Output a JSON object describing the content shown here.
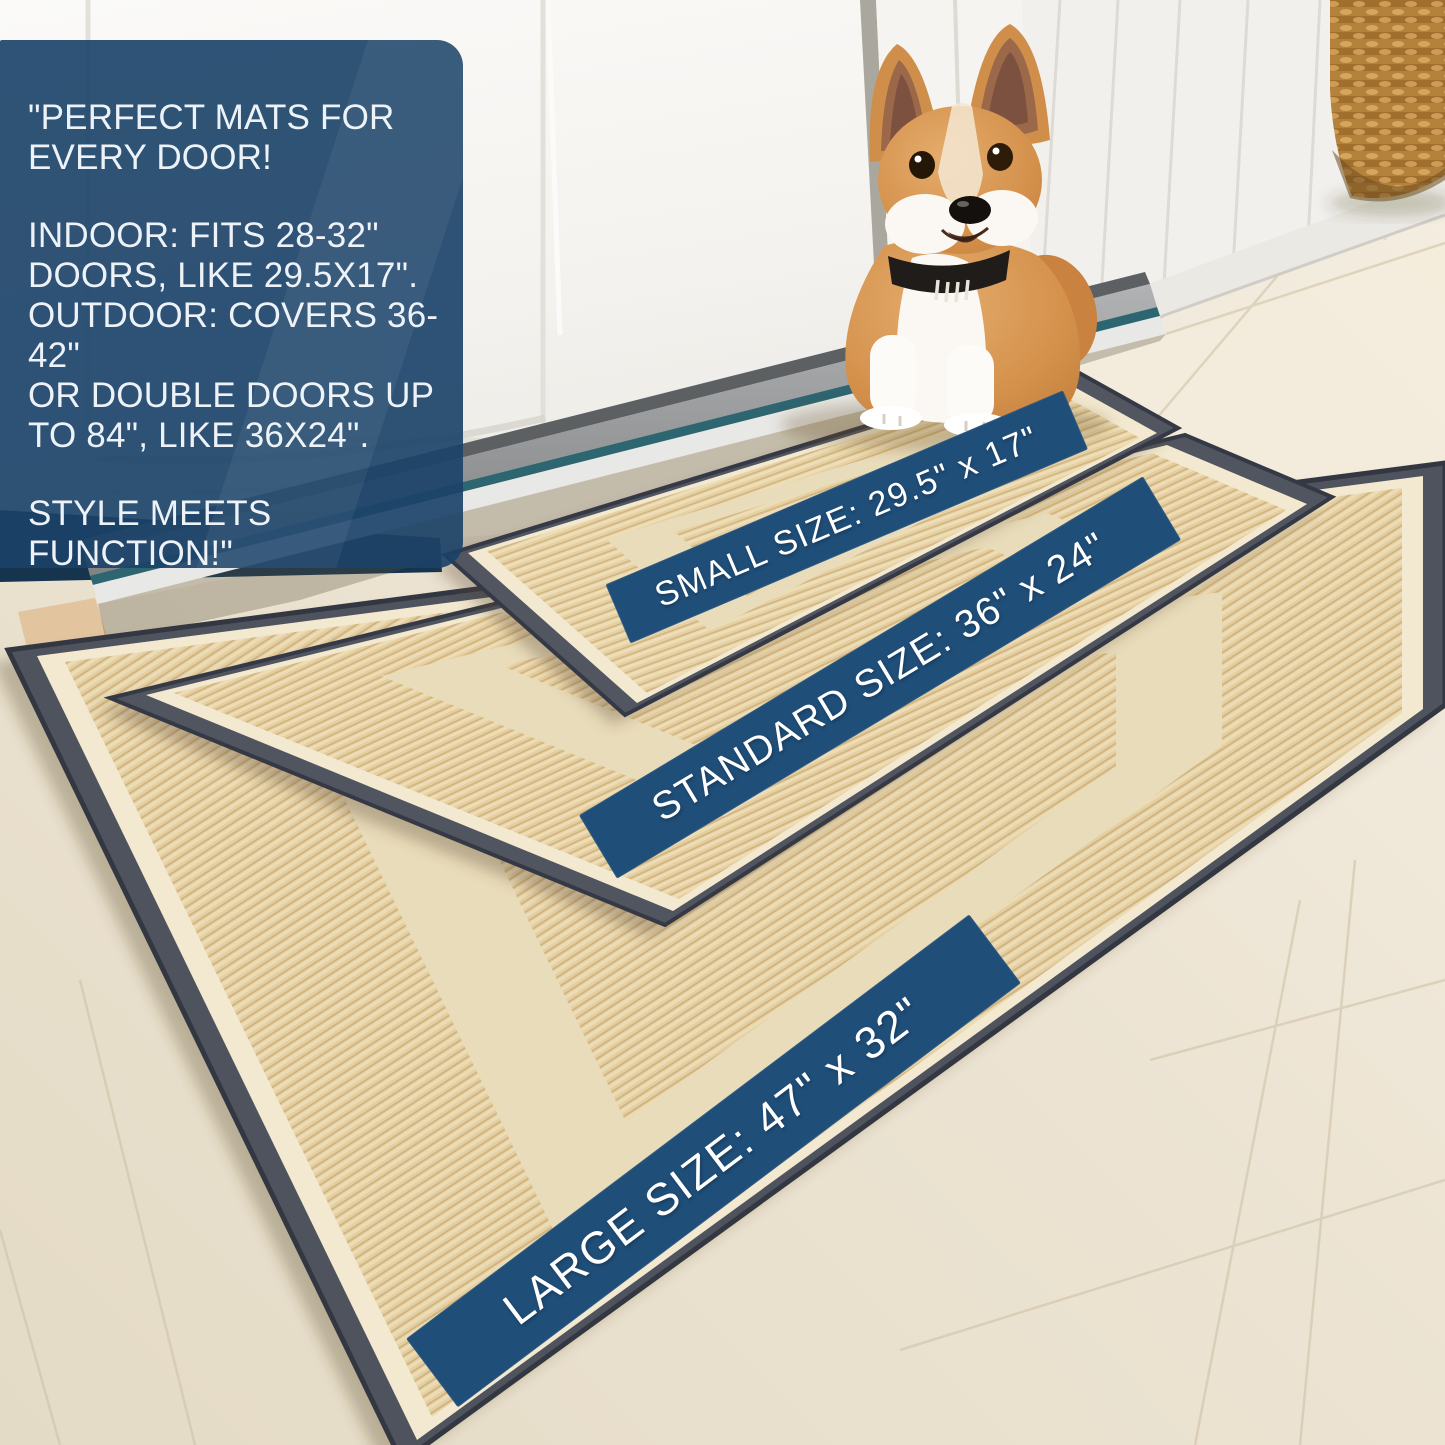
{
  "overlay_box": {
    "paragraph1": "\"PERFECT MATS FOR\nEVERY DOOR!",
    "paragraph2": "INDOOR: FITS 28-32\"\nDOORS, LIKE 29.5X17\".\nOUTDOOR: COVERS 36-42\"\nOR DOUBLE DOORS UP\nTO 84\", LIKE 36X24\".",
    "paragraph3": "STYLE MEETS FUNCTION!\""
  },
  "banners": {
    "small": {
      "label": "SMALL SIZE: 29.5\" x 17\""
    },
    "standard": {
      "label": "STANDARD SIZE: 36\" x 24\""
    },
    "large": {
      "label": "LARGE SIZE: 47\" x 32\""
    }
  },
  "colors": {
    "banner_blue": "#1f4e79",
    "box_blue": "#1a4268",
    "mat_border": "#4e535e",
    "mat_field": "#e6d1a4",
    "mat_accent_band": "#e9dcba",
    "mat_edge_line": "#f2e9d0",
    "threshold_teal": "#2d6571",
    "door_white": "#f8f7f4",
    "floor_light": "#f2ead9",
    "floor_dark": "#e5dcc8",
    "fur_tan": "#d4914c",
    "fur_white": "#fbf8f3"
  }
}
